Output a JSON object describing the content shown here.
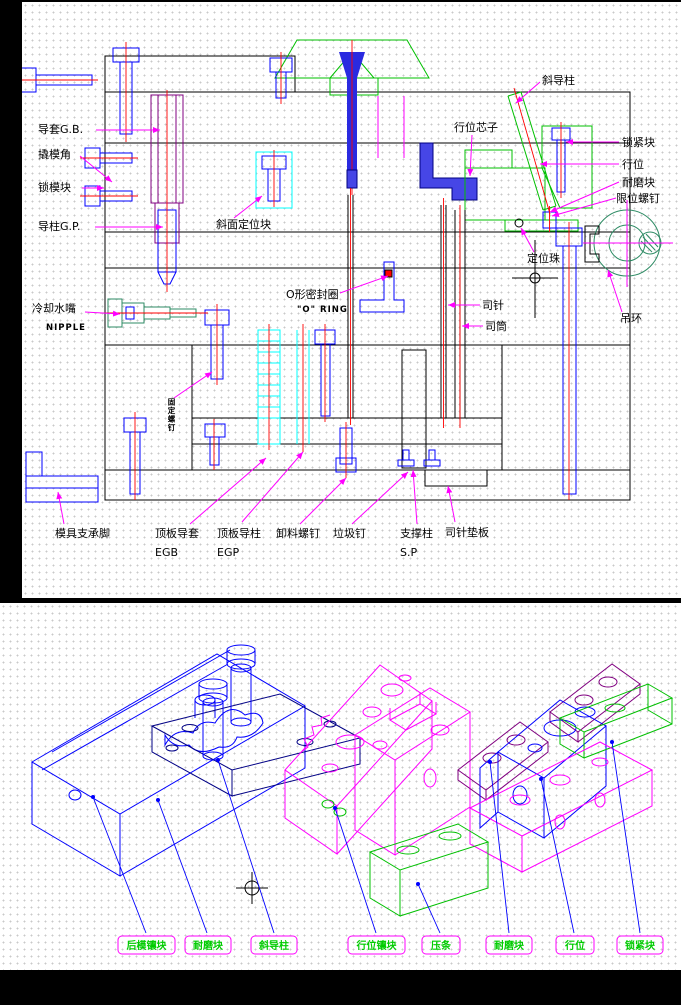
{
  "colors": {
    "background": "#000000",
    "paper": "#ffffff",
    "grid_dot": "#c8c8c8",
    "line_black": "#000000",
    "line_blue": "#0000ff",
    "line_green": "#00c000",
    "line_dark_green": "#2e8b64",
    "line_magenta": "#ff00ff",
    "line_cyan": "#00ffff",
    "line_red": "#ff0000",
    "line_purple": "#800080",
    "line_navy": "#000085",
    "label_green": "#00cc00"
  },
  "top_drawing": {
    "labels": {
      "guide_bushing": "导套G.B.",
      "pry_corner": "撬模角",
      "lock_block": "锁模块",
      "guide_pin": "导柱G.P.",
      "cooling_nipple": "冷却水嘴",
      "nipple_en": "NIPPLE",
      "taper_locating_block": "斜面定位块",
      "o_ring": "O形密封圈",
      "o_ring_en": "\"O\" RING",
      "angle_guide_pin": "斜导柱",
      "slide_core": "行位芯子",
      "locking_block": "锁紧块",
      "slide": "行位",
      "wear_block": "耐磨块",
      "limit_screw": "限位螺钉",
      "locating_ball": "定位珠",
      "ejector_pin": "司针",
      "ejector_sleeve": "司筒",
      "eye_bolt": "吊环",
      "fixing_screw": "固定螺钉",
      "mold_foot": "模具支承脚",
      "ejector_guide_bushing": "顶板导套",
      "egb": "EGB",
      "ejector_guide_pin": "顶板导柱",
      "egp": "EGP",
      "puller_screw": "卸料螺钉",
      "stop_pin": "垃圾钉",
      "support_pillar": "支撑柱",
      "sp": "S.P",
      "pin_retainer_plate": "司针垫板"
    }
  },
  "bottom_drawing": {
    "labels": [
      "后模镶块",
      "耐磨块",
      "斜导柱",
      "行位镶块",
      "压条",
      "耐磨块",
      "行位",
      "锁紧块"
    ]
  }
}
